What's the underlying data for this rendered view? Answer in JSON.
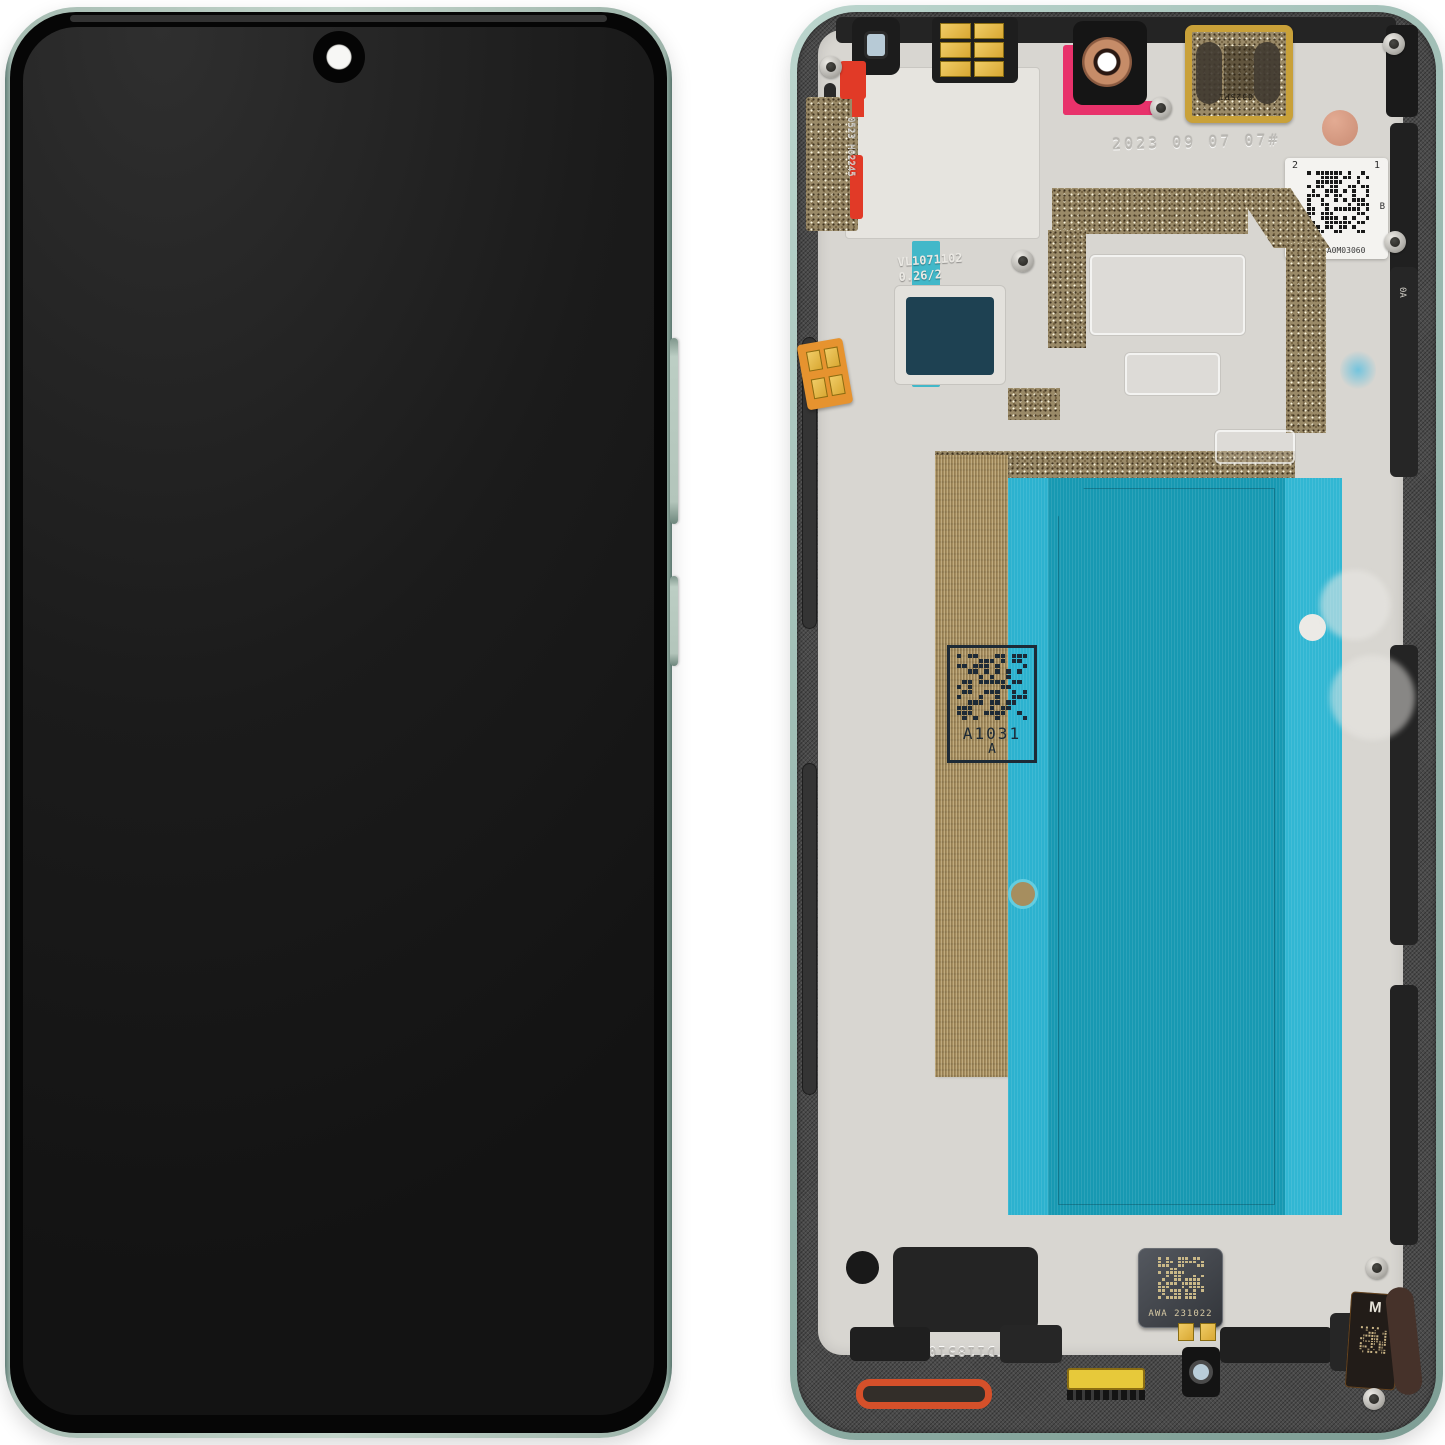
{
  "colors": {
    "frame_green": "#a9c2b8",
    "rail_dark": "#4a4a4a",
    "chassis_grey": "#d8d6d1",
    "adhesive_teal": "#1799b2",
    "adhesive_teal_light": "#2cb2cf",
    "cyan_tape": "#3ab6c8",
    "graphite_bronze": "#a68e5f",
    "mesh_bronze": "#9a8a68",
    "gold": "#c9a139",
    "red_adhesive": "#e13a27",
    "gasket_orange": "#d5502a",
    "camera_copper": "#c68c68",
    "coral_dot": "#d69a85",
    "screen_black": "#1a1a1a"
  },
  "back": {
    "date_stamp": "2023 09 07 07#",
    "corner_stamp": "0523 H02245",
    "tape_stamp": {
      "line1": "VL1071102",
      "line2": "0.26/2"
    },
    "datamatrix_label": {
      "top_left": "2",
      "top_right": "1",
      "side": "B",
      "code": "3B04A0M03060",
      "vertical_code": "TD0N12N118GAF"
    },
    "mid_label": {
      "code": "A1031",
      "rev": "A"
    },
    "motor_label": "AWA 231022",
    "earpiece_code": "032SP1",
    "frame_stamp": "TD1185101Z",
    "flex_letter": "M",
    "rail_code": "0A"
  }
}
